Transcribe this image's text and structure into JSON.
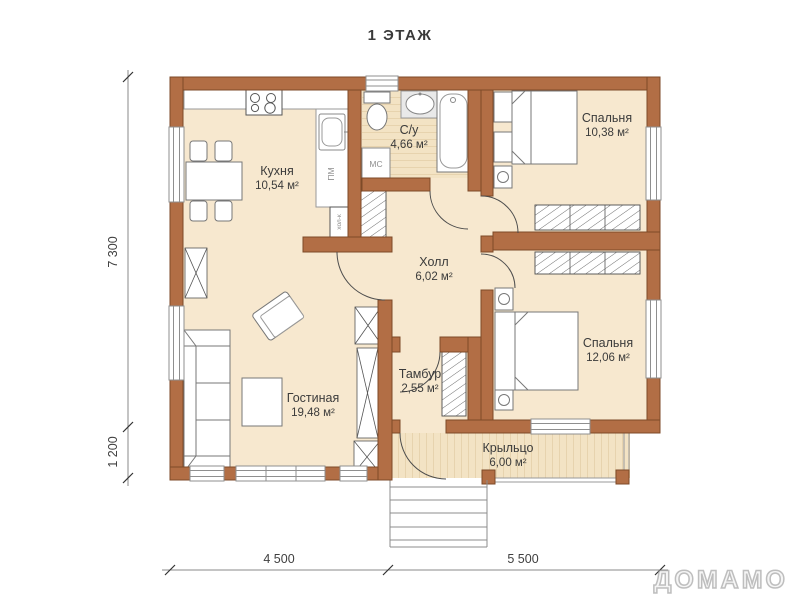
{
  "title": "1 ЭТАЖ",
  "watermark": {
    "center": "ДОМАМО",
    "corner": "ДОМАМО"
  },
  "rooms": [
    {
      "id": "kitchen",
      "name": "Кухня",
      "area": "10,54 м²"
    },
    {
      "id": "bathroom",
      "name": "С/у",
      "area": "4,66 м²"
    },
    {
      "id": "bedroom-1",
      "name": "Спальня",
      "area": "10,38 м²"
    },
    {
      "id": "hall",
      "name": "Холл",
      "area": "6,02 м²"
    },
    {
      "id": "bedroom-2",
      "name": "Спальня",
      "area": "12,06 м²"
    },
    {
      "id": "living-room",
      "name": "Гостиная",
      "area": "19,48 м²"
    },
    {
      "id": "vestibule",
      "name": "Тамбур",
      "area": "2,55 м²"
    },
    {
      "id": "porch",
      "name": "Крыльцо",
      "area": "6,00 м²"
    }
  ],
  "appliance_labels": {
    "dishwasher": "ПМ",
    "washing_machine": "МС",
    "fridge": "хол-к"
  },
  "dimensions": {
    "left_total": "7 300",
    "left_lower": "1 200",
    "bottom_left": "4 500",
    "bottom_right": "5 500"
  },
  "colors": {
    "wall": "#b26e45",
    "wall_outline": "#7d4a28",
    "floor": "#f7e8cf",
    "plank_floor": "#f3e3c4",
    "plank_stripe": "#e7d3ae",
    "furniture_outline": "#777777",
    "dimension_line": "#777777",
    "label_text": "#3b3b3b"
  }
}
